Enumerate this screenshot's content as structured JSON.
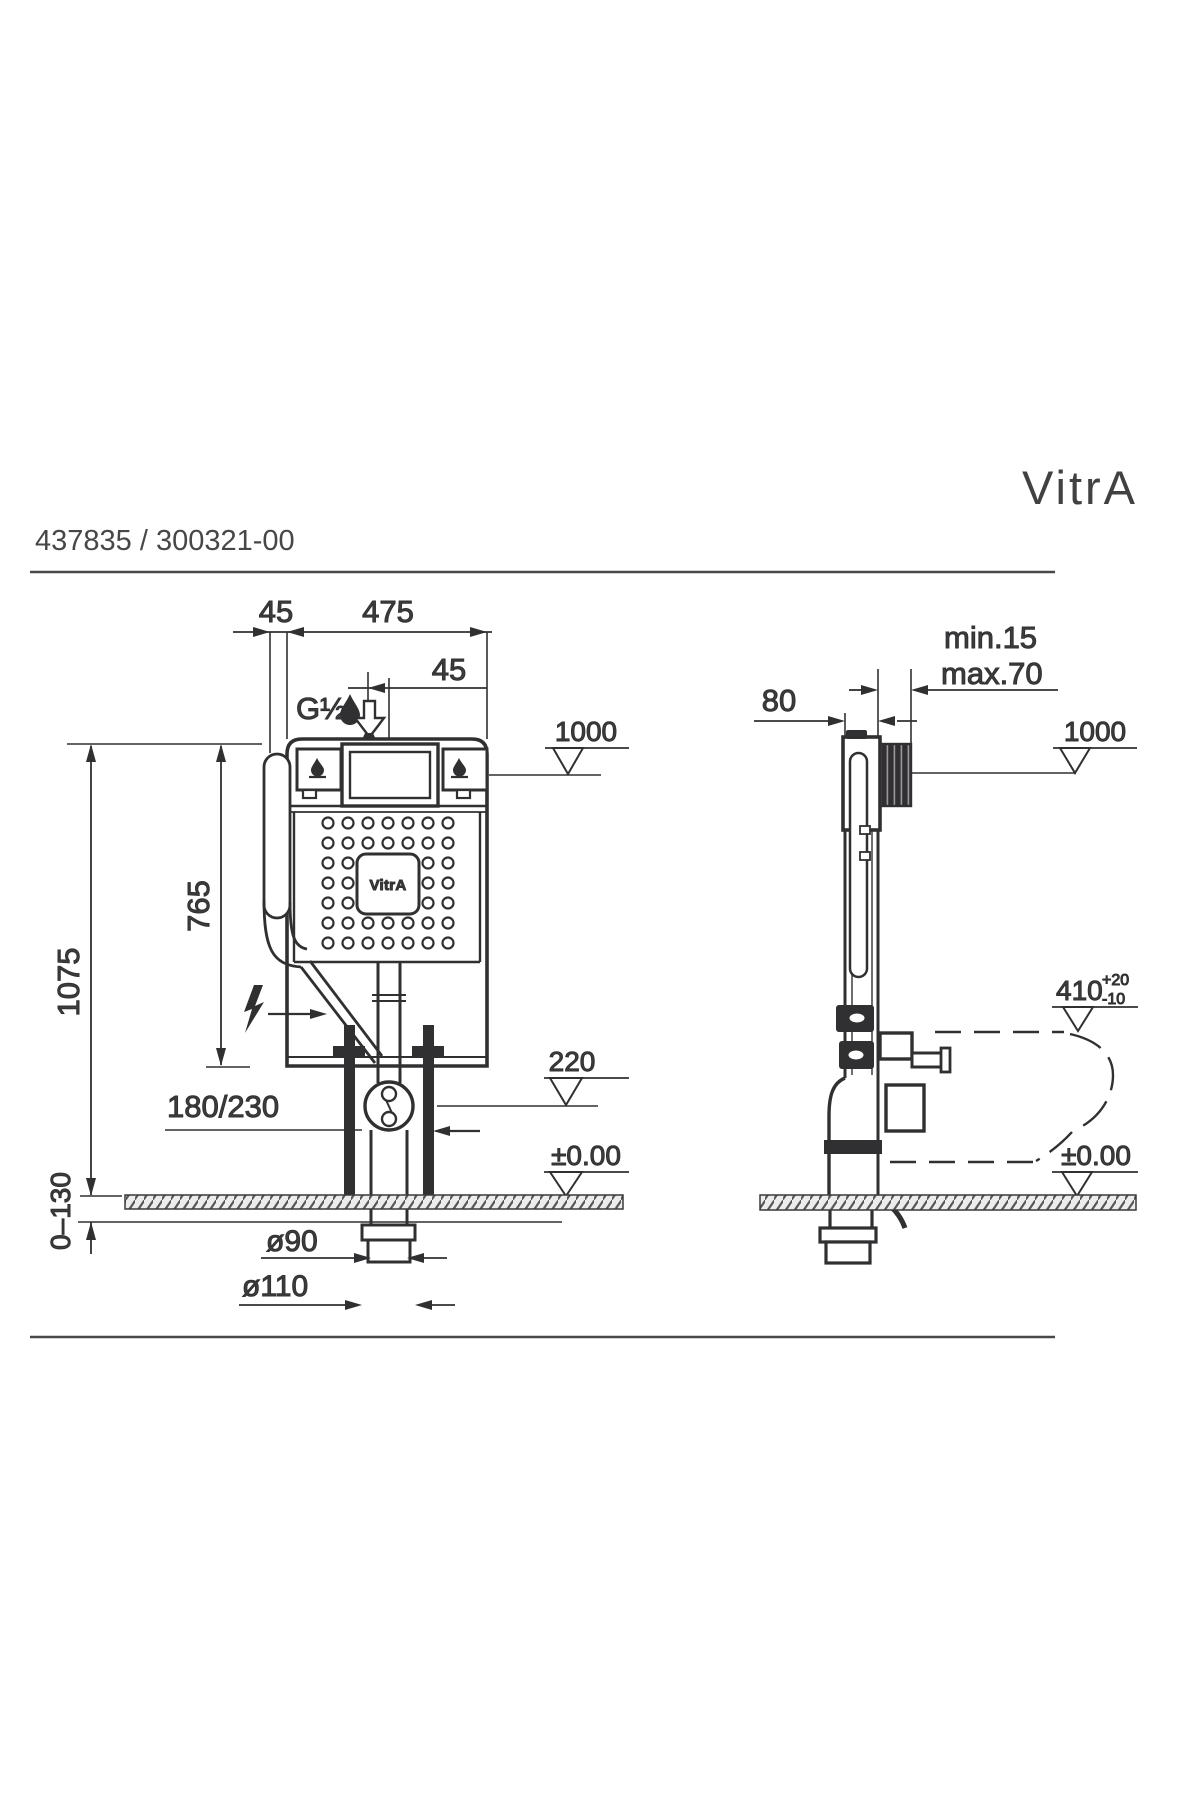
{
  "header": {
    "logo": "VitrA",
    "product_code": "437835 / 300321-00"
  },
  "front_view": {
    "dim_offset_top": "45",
    "dim_width": "475",
    "dim_inlet_offset": "45",
    "inlet_thread": "G½",
    "level_top": "1000",
    "height_total": "1075",
    "height_cistern": "765",
    "flush_pipe_offset": "180/230",
    "level_outlet": "220",
    "level_floor": "±0.00",
    "floor_adjust_range": "0–130",
    "outlet_diameter": "ø90",
    "drain_diameter": "ø110",
    "cistern_logo": "VitrA"
  },
  "side_view": {
    "dim_depth": "80",
    "wall_thickness_min": "min.15",
    "wall_thickness_max": "max.70",
    "level_top": "1000",
    "bowl_height": "410",
    "bowl_height_tol_plus": "+20",
    "bowl_height_tol_minus": "-10",
    "level_floor": "±0.00"
  },
  "colors": {
    "ink": "#303032",
    "text": "#3d3d3f",
    "paper": "#ffffff"
  }
}
